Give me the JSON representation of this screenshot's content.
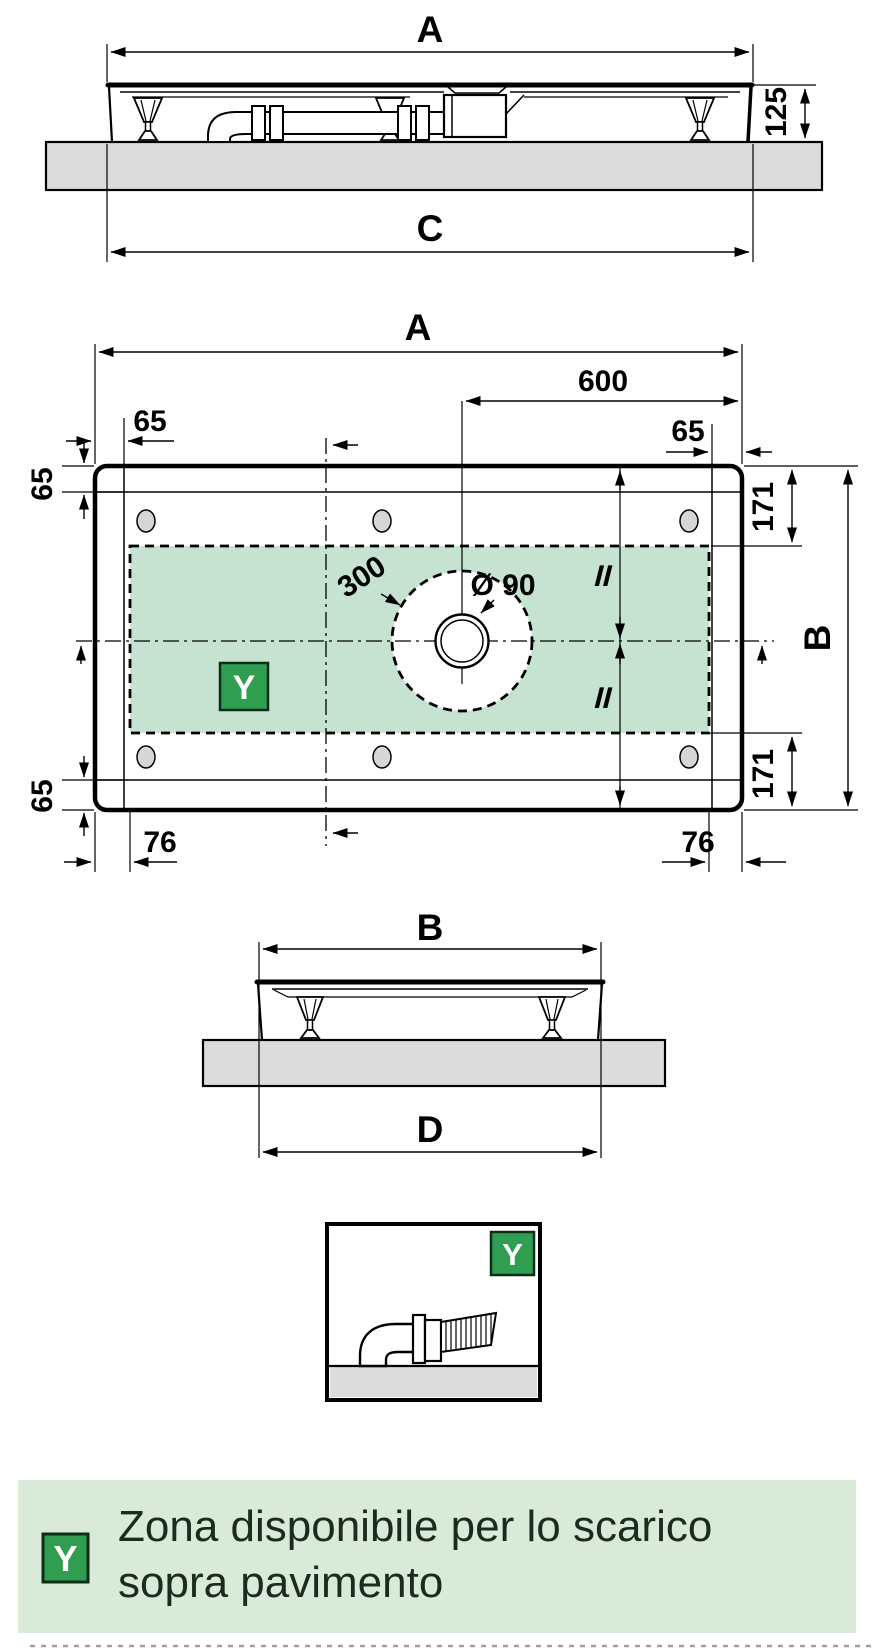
{
  "colors": {
    "zone_green": "#c6e2d0",
    "legend_band_green": "#d9ead9",
    "badge_green": "#2f9e50",
    "badge_border": "#0c2d18",
    "floor_gray": "#dcdcdc",
    "hole_gray": "#d6d6d6",
    "line_black": "#000000"
  },
  "front": {
    "width_label": "A",
    "height_label": "125",
    "base_label": "C"
  },
  "plan": {
    "width_label": "A",
    "drain_offset_label": "600",
    "edge_top_left_label": "65",
    "edge_top_right_label": "65",
    "rim_left_top_label": "65",
    "rim_left_bottom_label": "65",
    "zone_top_label": "171",
    "zone_bottom_label": "171",
    "depth_label": "B",
    "zone_left_label": "76",
    "zone_right_label": "76",
    "circle_label": "300",
    "drain_dia_label": "Ø 90",
    "equal_top": "II",
    "equal_bottom": "II",
    "badge": "Y"
  },
  "side": {
    "width_label": "B",
    "base_label": "D"
  },
  "detail": {
    "badge": "Y"
  },
  "legend": {
    "badge": "Y",
    "line1": "Zona disponibile per lo scarico",
    "line2": "sopra pavimento"
  }
}
